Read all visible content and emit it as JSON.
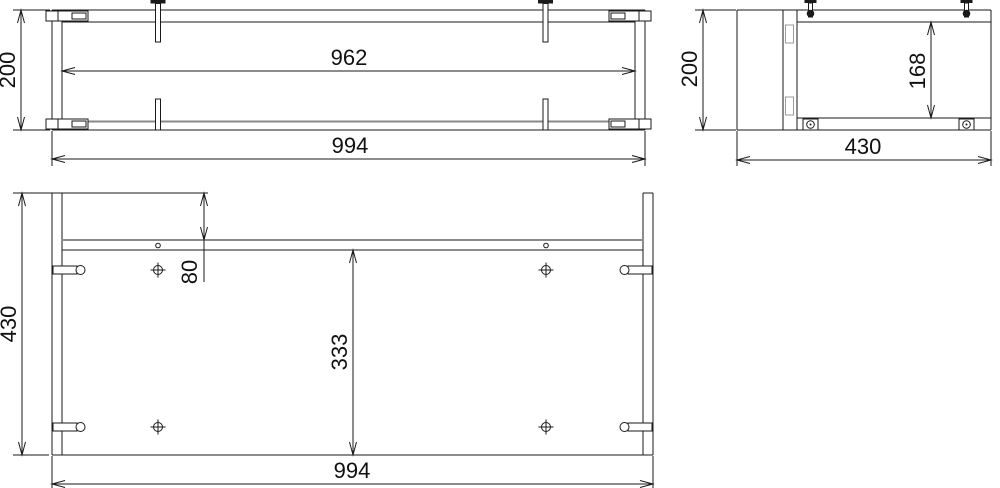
{
  "drawing": {
    "type": "technical-orthographic-drawing",
    "background_color": "#ffffff",
    "line_color": "#1a1a1a",
    "gray_line_color": "#8a8a8a",
    "views": [
      {
        "id": "front-view",
        "description": "front elevation"
      },
      {
        "id": "side-view",
        "description": "side elevation"
      },
      {
        "id": "plan-view",
        "description": "plan view"
      }
    ],
    "dimensions": [
      {
        "id": "front-opening-width",
        "view": "front-view",
        "label": "962",
        "value": 962,
        "orient": "h",
        "x1": 62,
        "x2": 635,
        "y": 71,
        "tx": 349,
        "ty": 65
      },
      {
        "id": "front-overall-width",
        "view": "front-view",
        "label": "994",
        "value": 994,
        "orient": "h",
        "x1": 52,
        "x2": 645,
        "y": 159,
        "tx": 350,
        "ty": 153,
        "ext": [
          [
            52,
            131,
            52,
            166
          ],
          [
            645,
            131,
            645,
            166
          ]
        ]
      },
      {
        "id": "front-overall-height",
        "view": "front-view",
        "label": "200",
        "value": 200,
        "orient": "v",
        "x": 21,
        "y1": 10,
        "y2": 130,
        "tx": 15,
        "ty": 70,
        "ext": [
          [
            13,
            10,
            50,
            10
          ],
          [
            13,
            130,
            50,
            130
          ]
        ]
      },
      {
        "id": "side-overall-height",
        "view": "side-view",
        "label": "200",
        "value": 200,
        "orient": "v",
        "x": 703,
        "y1": 10,
        "y2": 130,
        "tx": 697,
        "ty": 69,
        "ext": [
          [
            695,
            10,
            736,
            10
          ],
          [
            695,
            130,
            736,
            130
          ]
        ]
      },
      {
        "id": "side-opening-height",
        "view": "side-view",
        "label": "168",
        "value": 168,
        "orient": "v",
        "x": 931,
        "y1": 22,
        "y2": 118,
        "tx": 925,
        "ty": 71
      },
      {
        "id": "side-overall-depth",
        "view": "side-view",
        "label": "430",
        "value": 430,
        "orient": "h",
        "x1": 737,
        "x2": 991,
        "y": 160,
        "tx": 863,
        "ty": 154,
        "ext": [
          [
            737,
            131,
            737,
            166
          ],
          [
            991,
            131,
            991,
            166
          ]
        ]
      },
      {
        "id": "plan-overall-depth",
        "view": "plan-view",
        "label": "430",
        "value": 430,
        "orient": "v",
        "x": 22,
        "y1": 193,
        "y2": 455,
        "tx": 16,
        "ty": 324,
        "ext": [
          [
            13,
            193,
            208,
            193
          ],
          [
            13,
            455,
            49,
            455
          ]
        ]
      },
      {
        "id": "plan-rail-setback",
        "view": "plan-view",
        "label": "80",
        "value": 80,
        "orient": "v",
        "x": 204,
        "y1": 193,
        "y2": 240,
        "tail": 282,
        "tx": 197,
        "ty": 272
      },
      {
        "id": "plan-front-depth",
        "view": "plan-view",
        "label": "333",
        "value": 333,
        "orient": "v",
        "x": 353,
        "y1": 250,
        "y2": 455,
        "tx": 347,
        "ty": 352
      },
      {
        "id": "plan-overall-width",
        "view": "plan-view",
        "label": "994",
        "value": 994,
        "orient": "h",
        "x1": 52,
        "x2": 653,
        "y": 484,
        "tx": 352,
        "ty": 478,
        "ext": [
          [
            52,
            456,
            52,
            488
          ],
          [
            653,
            456,
            653,
            488
          ]
        ]
      }
    ]
  }
}
